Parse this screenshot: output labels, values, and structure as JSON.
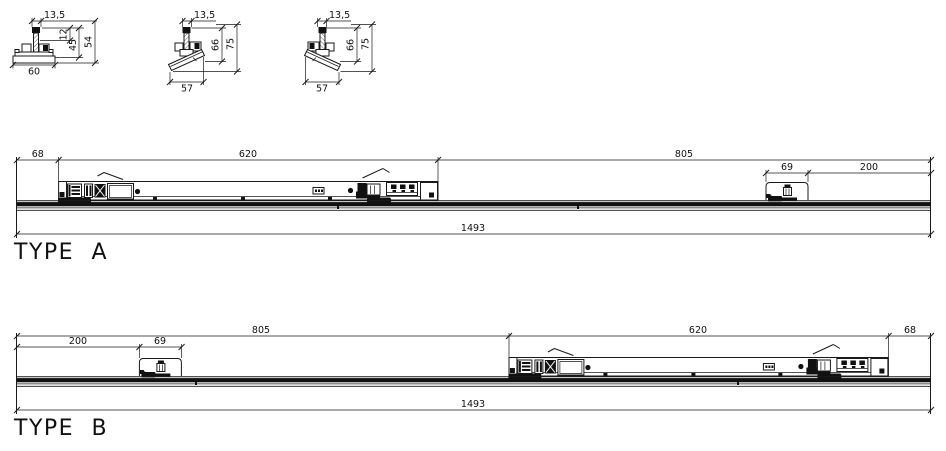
{
  "sections": {
    "straight": {
      "width_top": "13,5",
      "stem_offset": "12",
      "mid_height": "45",
      "total_height": "54",
      "base_width": "60"
    },
    "tilt_left": {
      "width_top": "13,5",
      "mid_height": "66",
      "total_height": "75",
      "base_width": "57"
    },
    "tilt_right": {
      "width_top": "13,5",
      "mid_height": "66",
      "total_height": "75",
      "base_width": "57"
    }
  },
  "type_a": {
    "label": "TYPE A",
    "dims": {
      "left_offset": "68",
      "carriage": "620",
      "right_span": "805",
      "trolley": "69",
      "right_offset": "200",
      "total": "1493"
    }
  },
  "type_b": {
    "label": "TYPE B",
    "dims": {
      "left_span": "805",
      "carriage": "620",
      "right_offset": "68",
      "left_offset": "200",
      "trolley": "69",
      "total": "1493"
    }
  }
}
